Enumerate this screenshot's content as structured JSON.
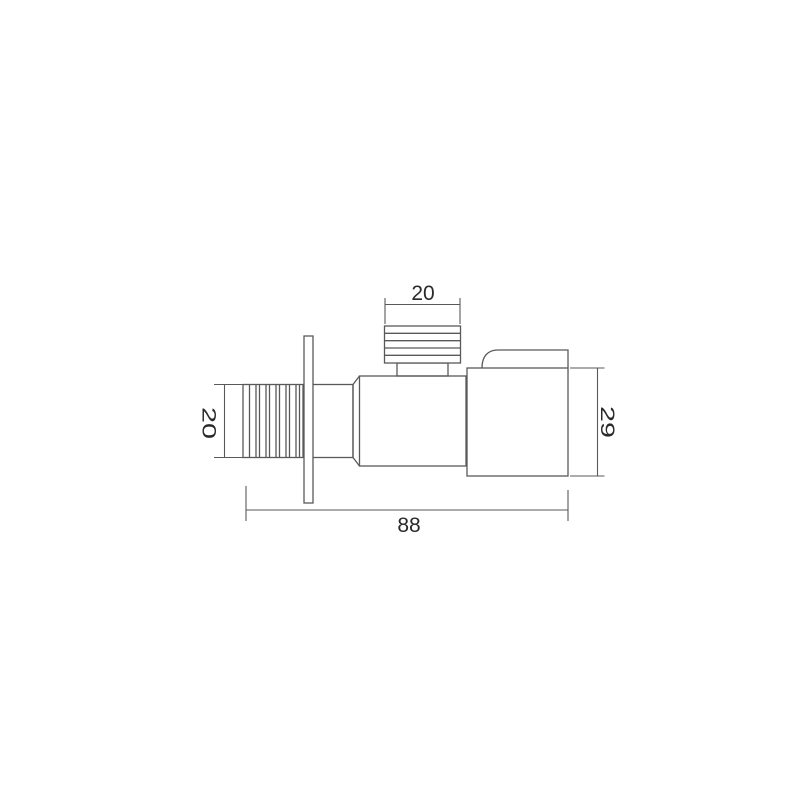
{
  "drawing": {
    "type": "technical-dimension-drawing",
    "background_color": "#ffffff",
    "line_color": "#595959",
    "text_color": "#2a2a2a",
    "dimensions": {
      "handle_width": "20",
      "inlet_height": "20",
      "outlet_height": "29",
      "overall_length": "88"
    }
  }
}
